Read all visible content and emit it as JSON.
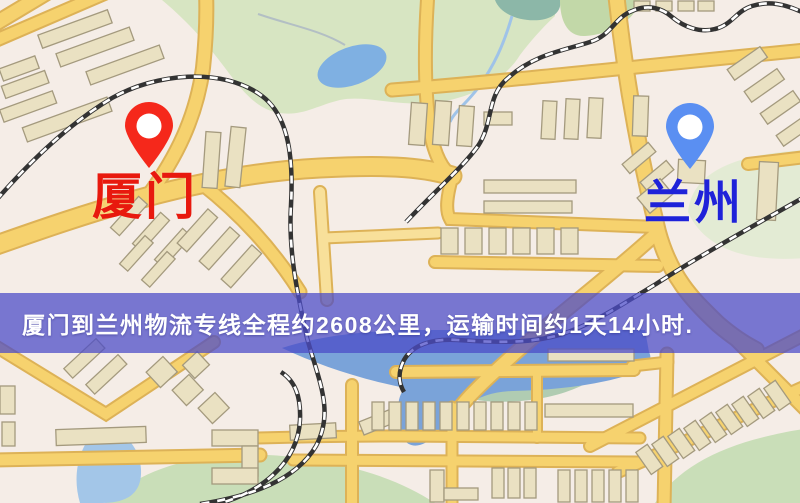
{
  "map": {
    "origin": {
      "label": "厦门",
      "pin_color": "#f5281b",
      "label_color": "#e8190e"
    },
    "destination": {
      "label": "兰州",
      "pin_color": "#5a8ff2",
      "label_color": "#1f22d9"
    },
    "banner": {
      "text": "厦门到兰州物流专线全程约2608公里，运输时间约1天14小时.",
      "background": "#4b4bc8",
      "text_color": "#ffffff"
    },
    "route": {
      "from": "厦门",
      "to": "兰州",
      "distance_km": 2608,
      "duration_text": "1天14小时"
    },
    "palette": {
      "road": "#f6d26e",
      "road_casing": "#ddb257",
      "building": "#eae1c2",
      "park": "#d7e5c2",
      "water": "#7aa3d9",
      "railway": "#333333",
      "background": "#f4efe7"
    }
  }
}
